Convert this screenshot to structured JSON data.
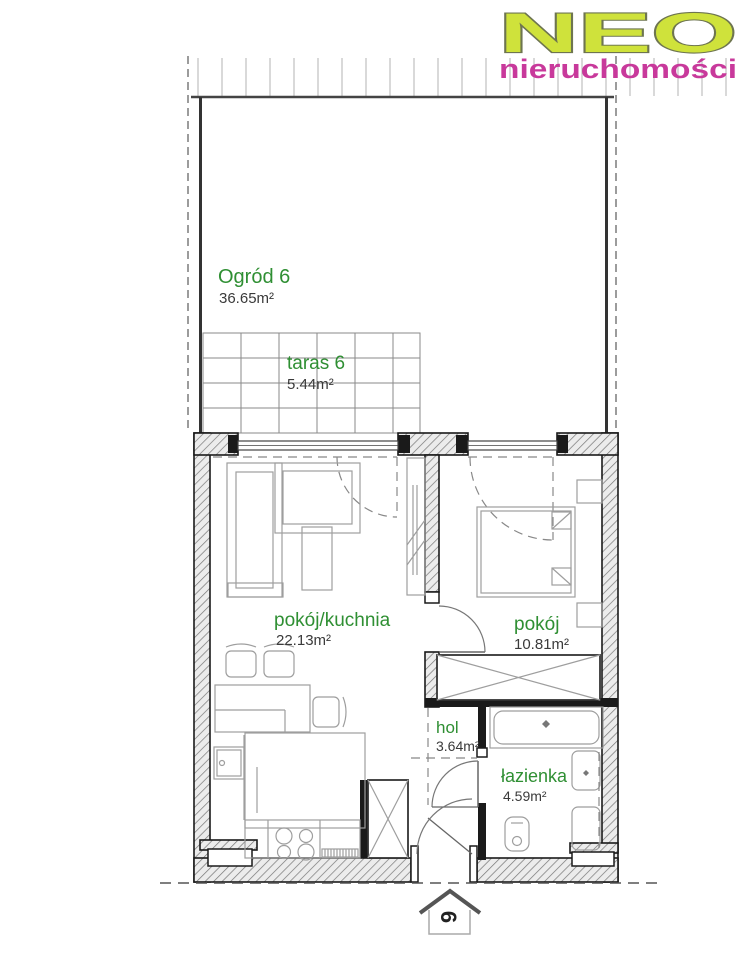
{
  "logo": {
    "brand": "NEO",
    "tagline": "nieruchomości"
  },
  "plan": {
    "garden": {
      "name": "Ogród 6",
      "area": "36.65m²"
    },
    "terrace": {
      "name": "taras 6",
      "area": "5.44m²"
    },
    "living_kitchen": {
      "name": "pokój/kuchnia",
      "area": "22.13m²"
    },
    "bedroom": {
      "name": "pokój",
      "area": "10.81m²"
    },
    "hall": {
      "name": "hol",
      "area": "3.64m²"
    },
    "bathroom": {
      "name": "łazienka",
      "area": "4.59m²"
    },
    "unit_number": "6"
  },
  "colors": {
    "room-label": "#2f8f33",
    "area-label": "#3a3a3a",
    "logo-lime": "#cfe23b",
    "logo-outline": "#6e7550",
    "logo-magenta": "#c8399b"
  }
}
